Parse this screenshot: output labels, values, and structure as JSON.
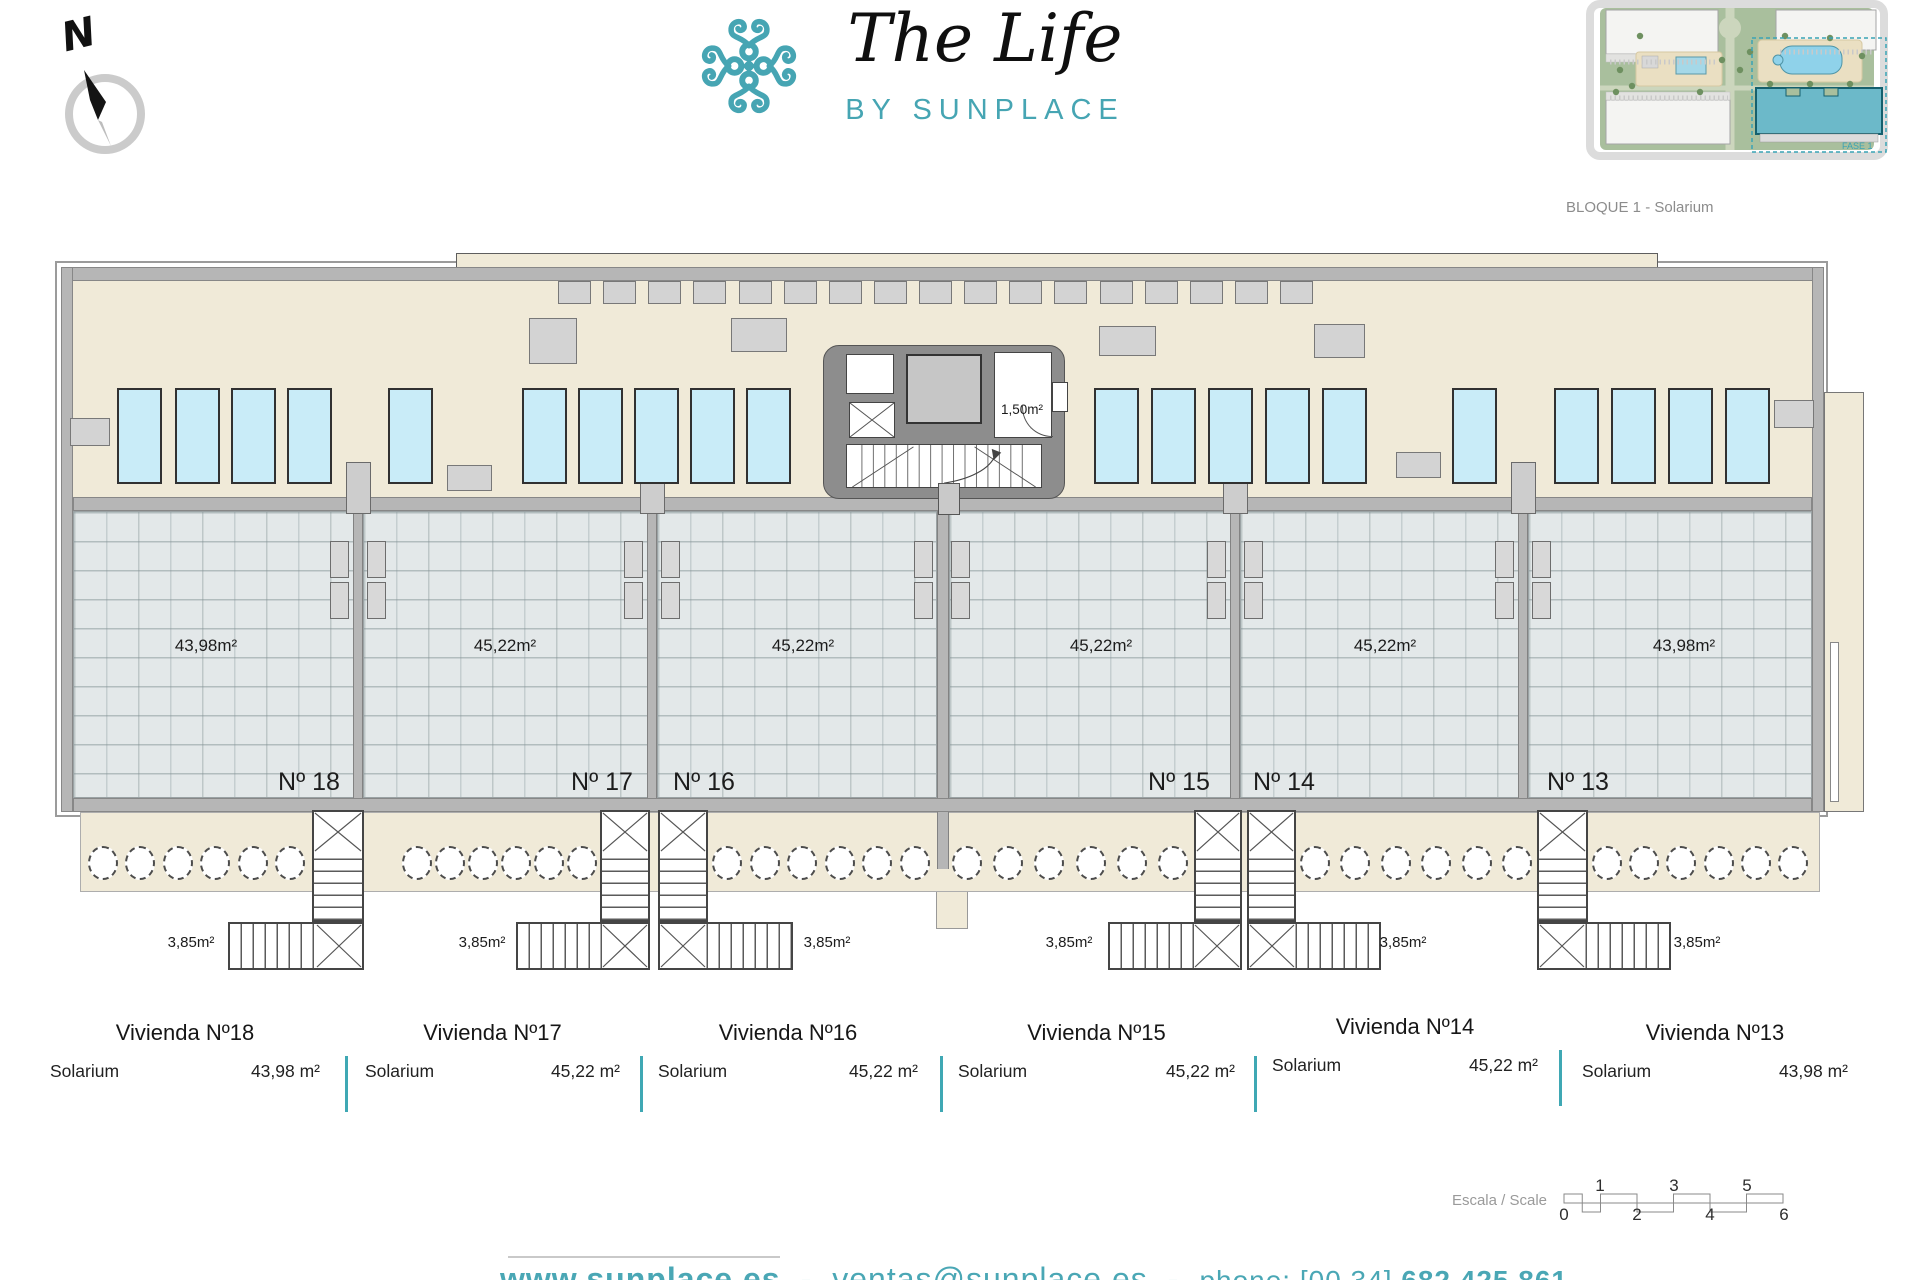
{
  "header": {
    "compass": {
      "label": "N"
    },
    "logo": {
      "title": "The Life",
      "subtitle": "BY SUNPLACE"
    },
    "site_plan": {
      "caption": "BLOQUE 1 - Solarium",
      "phase_label": "FASE 1"
    }
  },
  "plan": {
    "core": {
      "store_label": "1,50m²"
    },
    "units": [
      {
        "id": "18",
        "number": "Nº 18",
        "area": "43,98m²",
        "stair_area": "3,85m²"
      },
      {
        "id": "17",
        "number": "Nº 17",
        "area": "45,22m²",
        "stair_area": "3,85m²"
      },
      {
        "id": "16",
        "number": "Nº 16",
        "area": "45,22m²",
        "stair_area": "3,85m²"
      },
      {
        "id": "15",
        "number": "Nº 15",
        "area": "45,22m²",
        "stair_area": "3,85m²"
      },
      {
        "id": "14",
        "number": "Nº 14",
        "area": "45,22m²",
        "stair_area": "3,85m²"
      },
      {
        "id": "13",
        "number": "Nº 13",
        "area": "43,98m²",
        "stair_area": "3,85m²"
      }
    ]
  },
  "summary": {
    "columns": [
      {
        "title": "Vivienda Nº18",
        "row_label": "Solarium",
        "value": "43,98 m²"
      },
      {
        "title": "Vivienda Nº17",
        "row_label": "Solarium",
        "value": "45,22 m²"
      },
      {
        "title": "Vivienda Nº16",
        "row_label": "Solarium",
        "value": "45,22 m²"
      },
      {
        "title": "Vivienda Nº15",
        "row_label": "Solarium",
        "value": "45,22 m²"
      },
      {
        "title": "Vivienda Nº14",
        "row_label": "Solarium",
        "value": "45,22 m²"
      },
      {
        "title": "Vivienda Nº13",
        "row_label": "Solarium",
        "value": "43,98 m²"
      }
    ]
  },
  "scale_bar": {
    "label": "Escala / Scale",
    "top_ticks": [
      "1",
      "3",
      "5"
    ],
    "bottom_ticks": [
      "0",
      "2",
      "4",
      "6"
    ]
  },
  "footer": {
    "website": "www.sunplace.es",
    "sep1": "-",
    "email": "ventas@sunplace.es",
    "sep2": "-",
    "phone_prefix": "phone: [00 34]",
    "phone_number": "682 425 861"
  },
  "colors": {
    "teal": "#46a5b3",
    "terrace_beige": "#f0ead8",
    "tile_gray": "#e3e8e9",
    "wall_gray": "#b6b6b6",
    "sunbed_blue": "#c9ecf8"
  }
}
